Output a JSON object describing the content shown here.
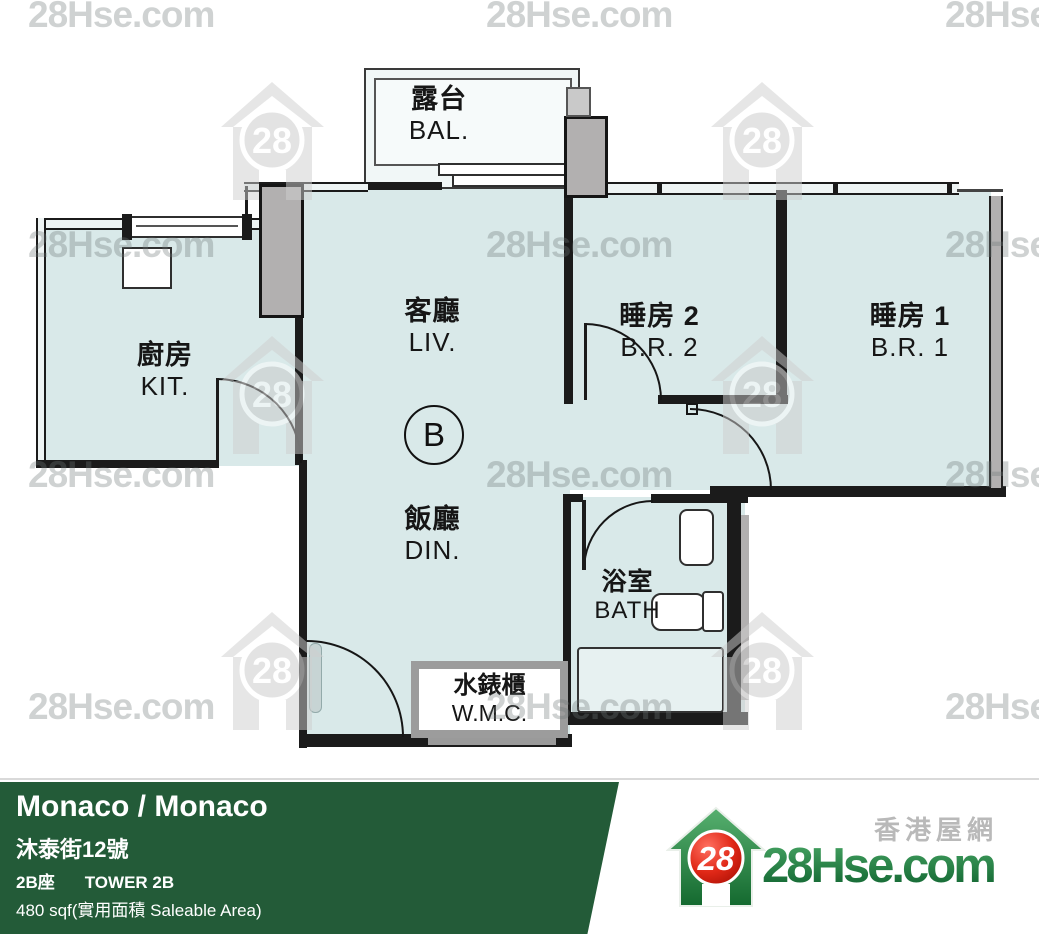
{
  "watermark": {
    "text": "28Hse.com",
    "logo_number": "28"
  },
  "plan": {
    "unit_label": "B",
    "rooms": {
      "balcony": {
        "zh": "露台",
        "en": "BAL."
      },
      "kitchen": {
        "zh": "廚房",
        "en": "KIT."
      },
      "living": {
        "zh": "客廳",
        "en": "LIV."
      },
      "dining": {
        "zh": "飯廳",
        "en": "DIN."
      },
      "bedroom2": {
        "zh": "睡房 2",
        "en": "B.R. 2"
      },
      "bedroom1": {
        "zh": "睡房 1",
        "en": "B.R. 1"
      },
      "bathroom": {
        "zh": "浴室",
        "en": "BATH"
      },
      "wmc": {
        "zh": "水錶櫃",
        "en": "W.M.C."
      }
    }
  },
  "footer": {
    "title": "Monaco / Monaco",
    "address": "沐泰街12號",
    "tower_zh": "2B座",
    "tower_en": "TOWER 2B",
    "area": "480 sqf(實用面積 Saleable Area)"
  },
  "brand": {
    "site_name_zh": "香港屋網",
    "site_name": "28Hse.com",
    "logo_number": "28"
  },
  "colors": {
    "bar_green": "#235b38",
    "logo_green": "#1e7c3c",
    "logo_red": "#d9261c",
    "floor_fill": "#d9e9e9",
    "watermark_gray": "#cfcfcf"
  }
}
